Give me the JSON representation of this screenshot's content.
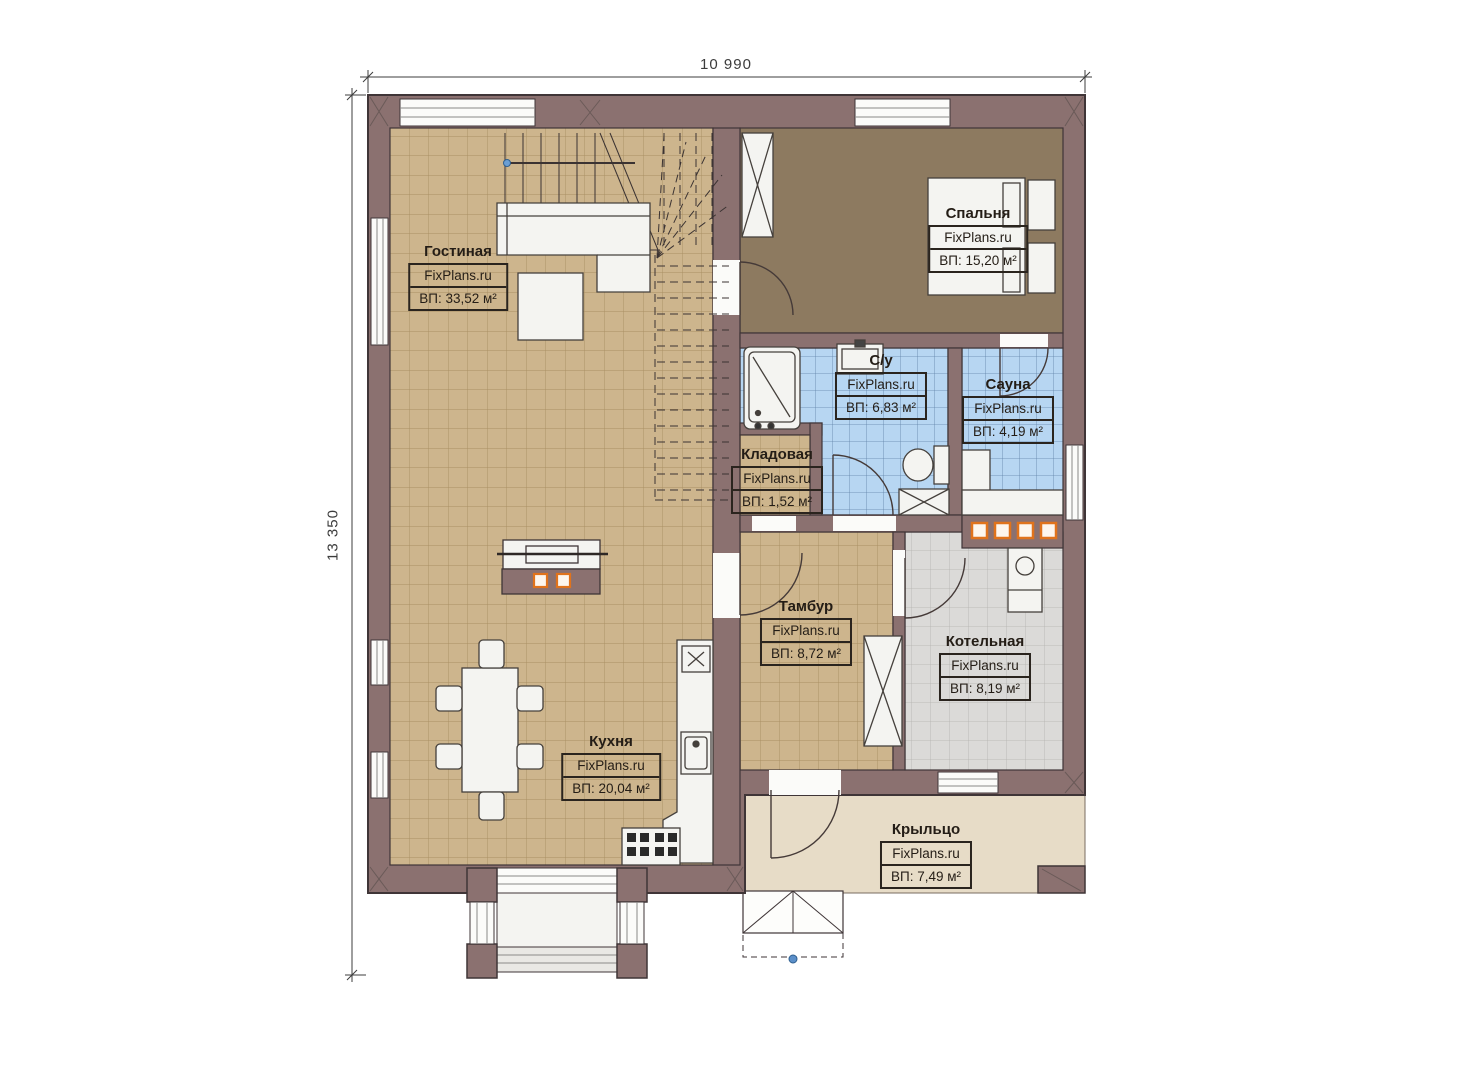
{
  "dimensions": {
    "width_label": "10 990",
    "height_label": "13 350"
  },
  "watermark": "FixPlans.ru",
  "rooms": [
    {
      "name": "Гостиная",
      "area": "ВП: 33,52 м²"
    },
    {
      "name": "Спальня",
      "area": "ВП: 15,20 м²"
    },
    {
      "name": "С/у",
      "area": "ВП: 6,83 м²"
    },
    {
      "name": "Сауна",
      "area": "ВП: 4,19 м²"
    },
    {
      "name": "Кладовая",
      "area": "ВП: 1,52 м²"
    },
    {
      "name": "Тамбур",
      "area": "ВП: 8,72 м²"
    },
    {
      "name": "Котельная",
      "area": "ВП: 8,19 м²"
    },
    {
      "name": "Кухня",
      "area": "ВП: 20,04 м²"
    },
    {
      "name": "Крыльцо",
      "area": "ВП: 7,49 м²"
    }
  ],
  "colors": {
    "wall": "#8b7170",
    "wall_outline": "#3f3537",
    "floor_tile_tan": "#cdb58d",
    "floor_brown": "#8d7a60",
    "floor_tile_blue": "#b7d6f2",
    "floor_tile_gray": "#dbdad8",
    "porch": "#e7dcc7",
    "furniture": "#f4f4f1",
    "heater_orange": "#e0731c",
    "marker_blue": "#5b8fc9"
  }
}
